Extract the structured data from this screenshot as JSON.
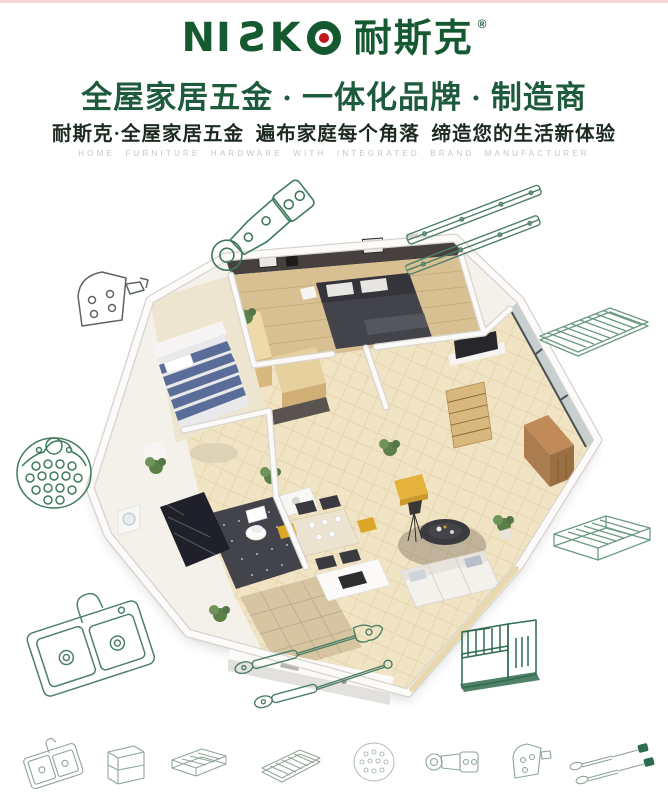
{
  "brand": {
    "logo_latin_prefix": "NI",
    "logo_latin_s": "S",
    "logo_latin_k": "K",
    "logo_cn": "耐斯克",
    "registered": "®"
  },
  "header": {
    "headline": "全屋家居五金 · 一体化品牌 · 制造商",
    "subheadline": "耐斯克·全屋家居五金  遍布家庭每个角落  缔造您的生活新体验",
    "tagline_en": "HOME FURNITURE HARDWARE WITH INTEGRATED BRAND MANUFACTURER"
  },
  "colors": {
    "brand_green": "#14592f",
    "headline_green": "#1e5a3c",
    "subheadline_dark": "#1d2a21",
    "tagline_gray": "#c6c6c6",
    "drawing_green": "#3f7a5c",
    "drawing_green_light": "#6b9a82",
    "drawing_green_dark": "#2f6b4e",
    "drawing_gray": "#5c665e",
    "accent_red_dot": "#c01818"
  },
  "hero": {
    "label": "isometric-apartment-cutaway-render"
  },
  "hardware_drawings": [
    "concealed-hinge",
    "ball-bearing-drawer-slides",
    "door-mounting-bracket",
    "wire-shelf-rack",
    "perforated-round-plate",
    "wire-pullout-basket",
    "double-bowl-sink-with-faucet",
    "gas-lift-struts",
    "wire-organizer-rack"
  ],
  "bottom_icons": [
    "double-sink-icon",
    "wire-cube-rack-icon",
    "wire-basket-icon",
    "wire-shelf-icon",
    "perforated-plate-icon",
    "concealed-hinge-icon",
    "mounting-bracket-icon",
    "gas-struts-icon"
  ]
}
